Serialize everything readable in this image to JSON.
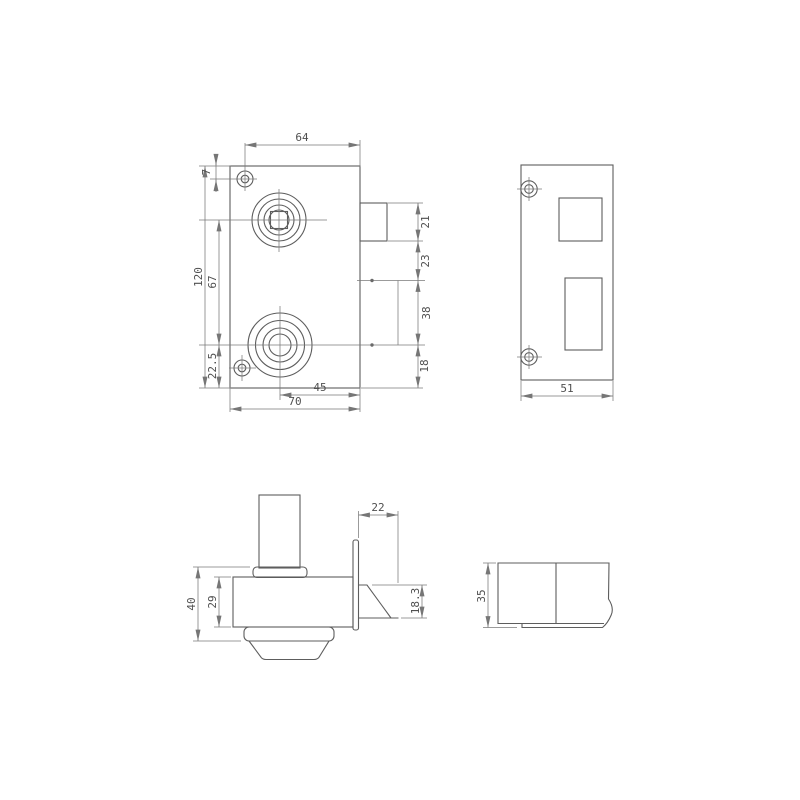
{
  "drawing": {
    "type": "technical-drawing",
    "subject": "rim lock with strike plate - dimensioned orthographic views",
    "colors": {
      "background": "#ffffff",
      "object_line": "#5d5d5d",
      "dimension_line": "#767676",
      "text": "#4f4f4f"
    },
    "views": {
      "front": {
        "dims": {
          "top_width": "64",
          "screw_offset": "7",
          "height": "120",
          "spindle_to_cylinder": "67",
          "cylinder_to_bottom": "22.5",
          "cylinder_to_edge": "45",
          "body_width": "70",
          "latch_height": "21",
          "latch_to_hub": "23",
          "hub_span": "38",
          "hub_to_bottom": "18"
        }
      },
      "strike_plate": {
        "dims": {
          "width": "51"
        }
      },
      "side": {
        "dims": {
          "latch_protrusion": "22",
          "overall_depth": "40",
          "case_depth": "29",
          "latch_thickness": "18.3"
        }
      },
      "strike_box": {
        "dims": {
          "depth": "35"
        }
      }
    }
  }
}
